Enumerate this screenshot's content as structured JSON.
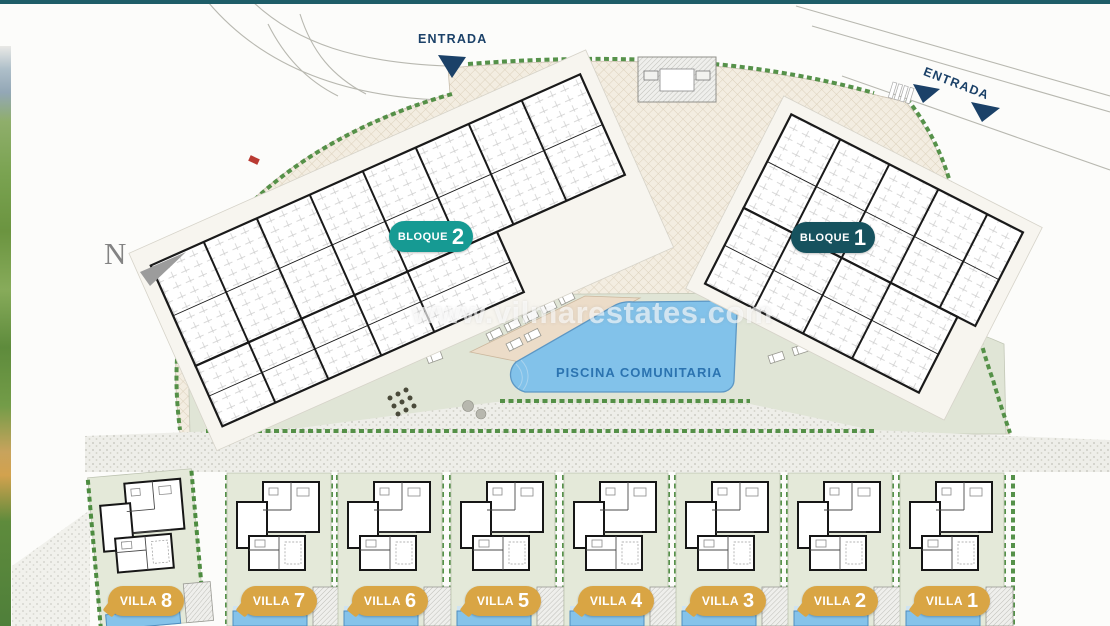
{
  "meta": {
    "title": "Residential development site plan",
    "top_bar_color": "#1e5d68"
  },
  "north": {
    "label": "N"
  },
  "entrances": {
    "top": "ENTRADA",
    "right": "ENTRADA",
    "arrow_color": "#1b4168"
  },
  "blocks": {
    "bloque2": {
      "word": "BLOQUE",
      "number": "2",
      "badge_color": "#169a93"
    },
    "bloque1": {
      "word": "BLOQUE",
      "number": "1",
      "badge_color": "#16525e"
    }
  },
  "amenities": {
    "pool_label": "PISCINA COMUNITARIA",
    "pool_water_color": "#82c2ea",
    "pool_label_color": "#2b73b0"
  },
  "watermark": {
    "text": "www.vilmarestates.com"
  },
  "villas": [
    {
      "word": "VILLA",
      "number": "8"
    },
    {
      "word": "VILLA",
      "number": "7"
    },
    {
      "word": "VILLA",
      "number": "6"
    },
    {
      "word": "VILLA",
      "number": "5"
    },
    {
      "word": "VILLA",
      "number": "4"
    },
    {
      "word": "VILLA",
      "number": "3"
    },
    {
      "word": "VILLA",
      "number": "2"
    },
    {
      "word": "VILLA",
      "number": "1"
    }
  ],
  "colors": {
    "villa_badge": "#d9a544",
    "hedge_green": "#4d8c40",
    "amenity_green": "#e0e5d6",
    "villa_plot_green": "#e4e9d9",
    "hatch_tan": "#f3ede1",
    "entrance_navy": "#1b4168"
  }
}
